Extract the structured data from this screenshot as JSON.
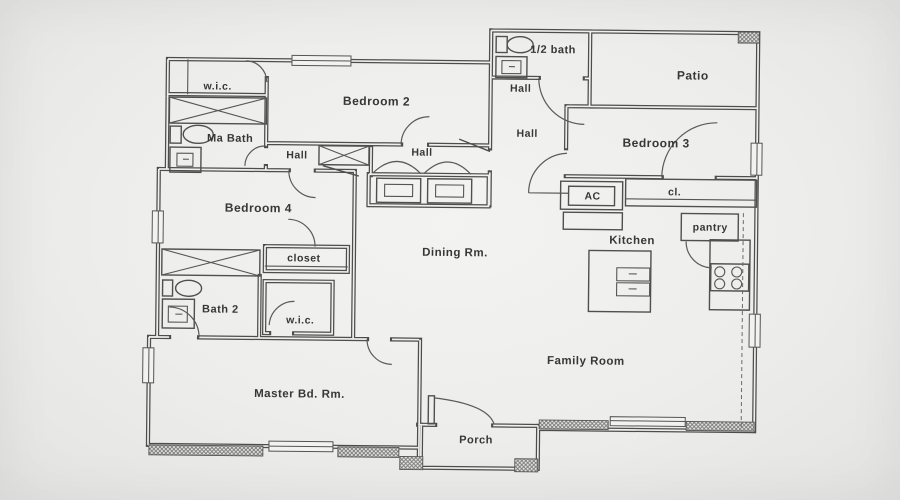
{
  "drawing": {
    "kind": "single-story house floor plan",
    "colors": {
      "paper": "#f0f0ee",
      "line": "#4d4d4d",
      "text": "#373737",
      "hatch": "#777777"
    }
  },
  "rooms": {
    "wic_top": "w.i.c.",
    "ma_bath": "Ma Bath",
    "bedroom2": "Bedroom 2",
    "hall_west": "Hall",
    "hall_center": "Hall",
    "half_bath": "1/2 bath",
    "hall_upper": "Hall",
    "hall_east": "Hall",
    "patio": "Patio",
    "bedroom3": "Bedroom 3",
    "ac": "AC",
    "cl": "cl.",
    "kitchen": "Kitchen",
    "pantry": "pantry",
    "bedroom4": "Bedroom 4",
    "closet": "closet",
    "bath2": "Bath 2",
    "wic_lower": "w.i.c.",
    "dining": "Dining Rm.",
    "master": "Master Bd. Rm.",
    "family": "Family Room",
    "porch": "Porch"
  },
  "fixtures": [
    "toilet-icon",
    "sink-icon",
    "shower-icon",
    "bathtub-icon",
    "linen-closet-icon",
    "washer-icon",
    "dryer-icon",
    "kitchen-island-icon",
    "stove-icon",
    "window-symbol",
    "door-swing-symbol",
    "masonry-hatch-symbol"
  ]
}
